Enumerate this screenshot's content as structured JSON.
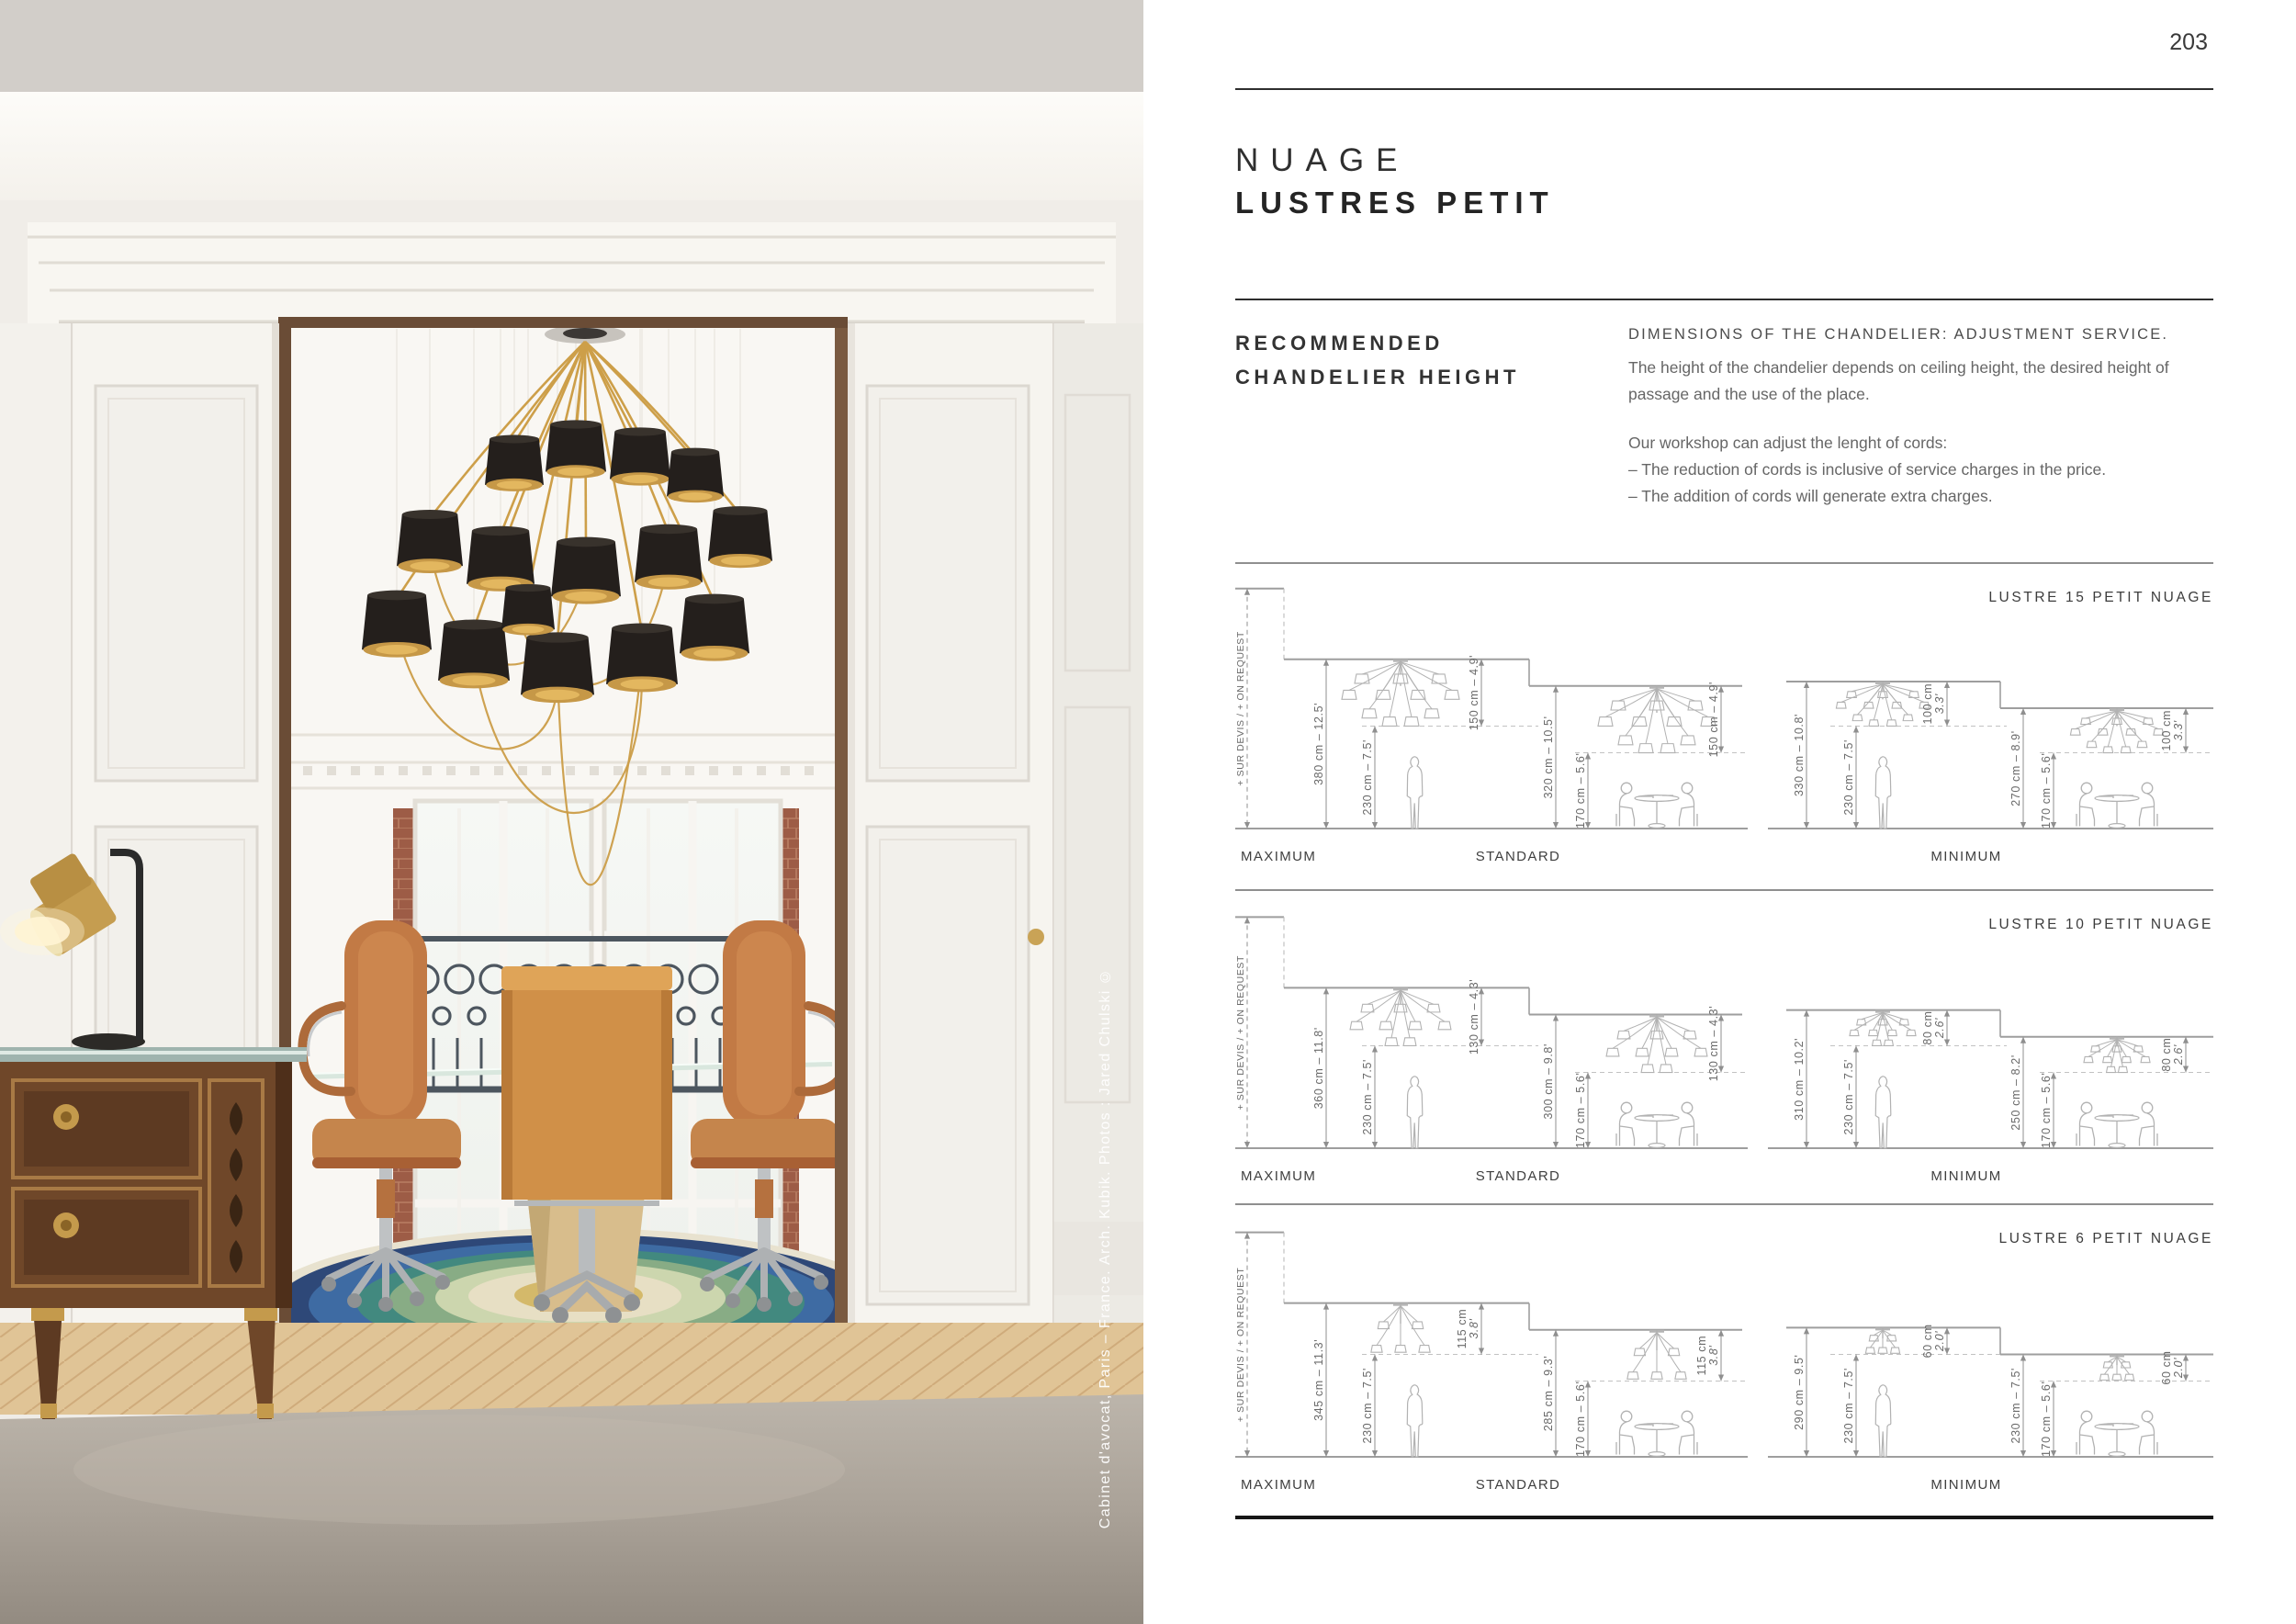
{
  "page": {
    "number": "203"
  },
  "product": {
    "title_line1": "NUAGE",
    "title_line2": "LUSTRES PETIT"
  },
  "recommendation": {
    "heading_line1": "RECOMMENDED",
    "heading_line2": "CHANDELIER HEIGHT",
    "dim_heading": "DIMENSIONS OF THE CHANDELIER: ADJUSTMENT SERVICE.",
    "para1_line1": "The height of the chandelier depends on ceiling height, the desired height of",
    "para1_line2": "passage and the use of the place.",
    "para2_line1": "Our workshop can adjust the lenght of cords:",
    "para2_line2": "– The reduction of cords is inclusive of service charges in the price.",
    "para2_line3": "– The addition of cords will generate extra charges."
  },
  "photo": {
    "credit": "Cabinet d'avocat, Paris – France. Arch. Kubik. Photos : Jared Chulski ©"
  },
  "group_labels": {
    "maximum": "MAXIMUM",
    "standard": "STANDARD",
    "minimum": "MINIMUM"
  },
  "on_request_label": "+ SUR DEVIS / + ON REQUEST",
  "sections": [
    {
      "title": "LUSTRE 15 PETIT NUAGE",
      "shades": 15,
      "maximum": {
        "ceiling_cm": 380,
        "ceiling": "380 cm – 12.5'",
        "drop_cm": 150,
        "drop": "150 cm – 4.9'",
        "clearance_cm": 230,
        "clearance": "230 cm – 7.5'"
      },
      "standard": {
        "ceiling_cm": 320,
        "ceiling": "320 cm – 10.5'",
        "drop_cm": 150,
        "drop": "150 cm – 4.9'",
        "clearance_cm": 170,
        "clearance": "170 cm – 5.6'"
      },
      "minimum_tall": {
        "ceiling_cm": 330,
        "ceiling": "330 cm – 10.8'",
        "drop_cm": 100,
        "drop": "100 cm\n3.3'",
        "clearance_cm": 230,
        "clearance": "230 cm – 7.5'"
      },
      "minimum_low": {
        "ceiling_cm": 270,
        "ceiling": "270 cm – 8.9'",
        "drop_cm": 100,
        "drop": "100 cm\n3.3'",
        "clearance_cm": 170,
        "clearance": "170 cm – 5.6'"
      }
    },
    {
      "title": "LUSTRE 10 PETIT NUAGE",
      "shades": 10,
      "maximum": {
        "ceiling_cm": 360,
        "ceiling": "360 cm – 11.8'",
        "drop_cm": 130,
        "drop": "130 cm – 4.3'",
        "clearance_cm": 230,
        "clearance": "230 cm – 7.5'"
      },
      "standard": {
        "ceiling_cm": 300,
        "ceiling": "300 cm – 9.8'",
        "drop_cm": 130,
        "drop": "130 cm – 4.3'",
        "clearance_cm": 170,
        "clearance": "170 cm – 5.6'"
      },
      "minimum_tall": {
        "ceiling_cm": 310,
        "ceiling": "310 cm – 10.2'",
        "drop_cm": 80,
        "drop": "80 cm\n2.6'",
        "clearance_cm": 230,
        "clearance": "230 cm – 7.5'"
      },
      "minimum_low": {
        "ceiling_cm": 250,
        "ceiling": "250 cm – 8.2'",
        "drop_cm": 80,
        "drop": "80 cm\n2.6'",
        "clearance_cm": 170,
        "clearance": "170 cm – 5.6'"
      }
    },
    {
      "title": "LUSTRE 6 PETIT NUAGE",
      "shades": 6,
      "maximum": {
        "ceiling_cm": 345,
        "ceiling": "345 cm – 11.3'",
        "drop_cm": 115,
        "drop": "115 cm\n3.8'",
        "clearance_cm": 230,
        "clearance": "230 cm – 7.5'"
      },
      "standard": {
        "ceiling_cm": 285,
        "ceiling": "285 cm – 9.3'",
        "drop_cm": 115,
        "drop": "115 cm\n3.8'",
        "clearance_cm": 170,
        "clearance": "170 cm – 5.6'"
      },
      "minimum_tall": {
        "ceiling_cm": 290,
        "ceiling": "290 cm – 9.5'",
        "drop_cm": 60,
        "drop": "60 cm\n2.0'",
        "clearance_cm": 230,
        "clearance": "230 cm – 7.5'"
      },
      "minimum_low": {
        "ceiling_cm": 230,
        "ceiling": "230 cm – 7.5'",
        "drop_cm": 60,
        "drop": "60 cm\n2.0'",
        "clearance_cm": 170,
        "clearance": "170 cm – 5.6'"
      }
    }
  ]
}
